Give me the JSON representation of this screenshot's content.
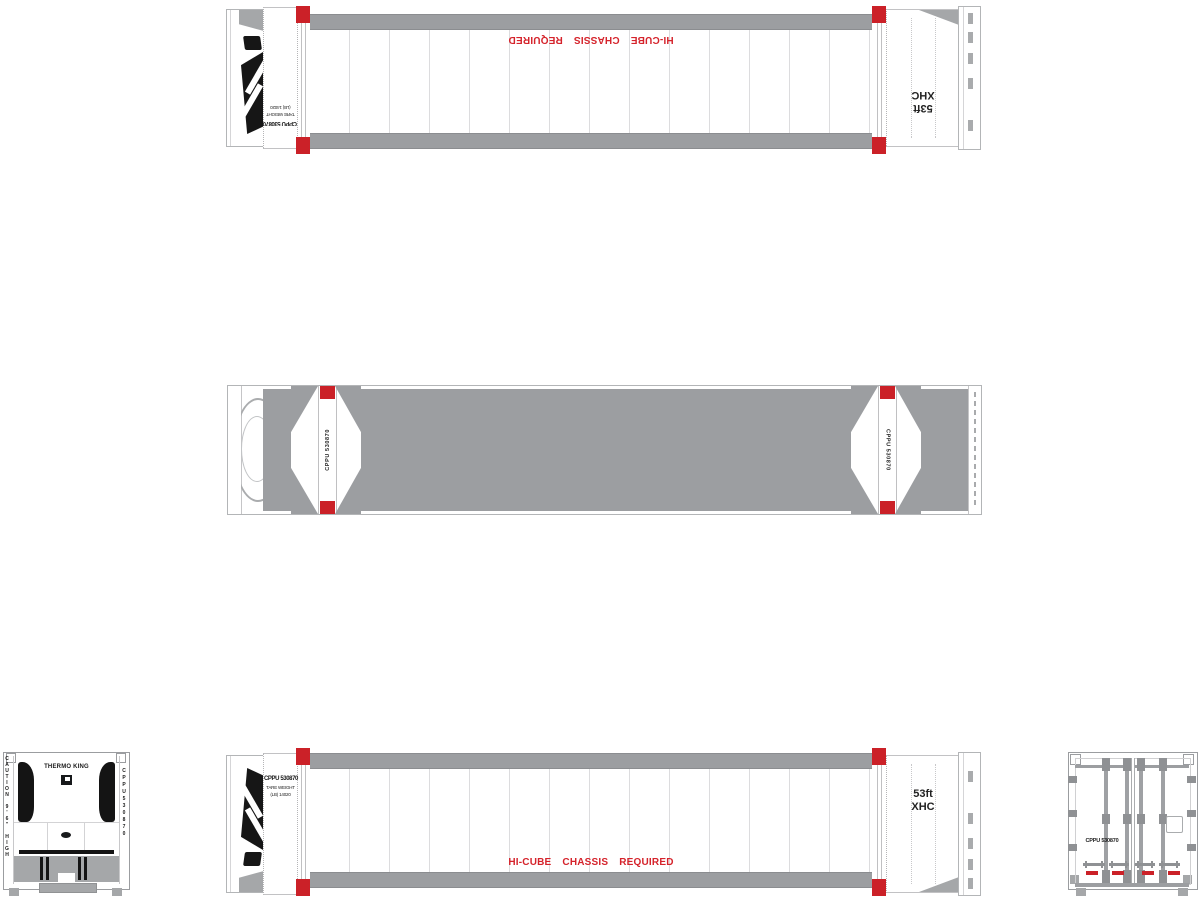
{
  "palette": {
    "container_white": "#ffffff",
    "rail_gray": "#9c9ea1",
    "hardware_gray": "#8f9194",
    "skirt_gray": "#a5a7a9",
    "marker_red": "#cb2128",
    "text_red": "#d5232b",
    "text_black": "#1a1a1a"
  },
  "side_view": {
    "unit_number": "CPPU 530870",
    "tare_label": "TARE WEIGHT",
    "tare_value": "(LB) 14020",
    "size_code_line1": "53ft",
    "size_code_line2": "XHC",
    "chassis_note": "HI-CUBE CHASSIS REQUIRED"
  },
  "roof_view": {
    "unit_number_left": "CPPU 530870",
    "unit_number_right": "CPPU 530870"
  },
  "front_view": {
    "brand": "THERMO KING",
    "caution_vertical": "CAUTION 9'6\" HIGH",
    "unit_number_vertical": "CPPU530870"
  },
  "rear_view": {
    "unit_number": "CPPU 530870"
  }
}
